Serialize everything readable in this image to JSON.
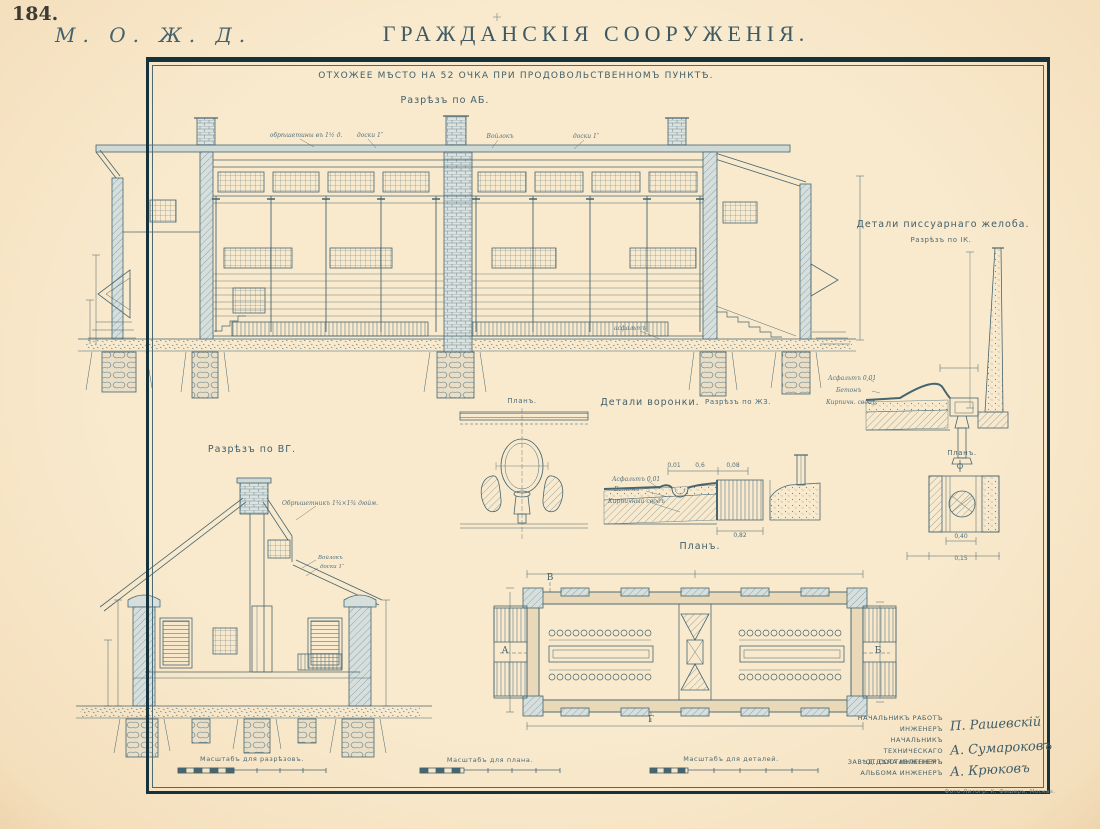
{
  "page": {
    "number": "184.",
    "railway": "М. О. Ж. Д.",
    "title": "ГРАЖДАНСКІЯ СООРУЖЕНІЯ.",
    "subtitle": "ОТХОЖЕЕ МѢСТО НА 52 ОЧКА ПРИ ПРОДОВОЛЬСТВЕННОМЪ ПУНКТѢ.",
    "imprint": "Фото-Литогр. К. Фишеръ, Москва."
  },
  "drawings": {
    "section_ab": {
      "label": "Разрѣзъ по АБ.",
      "roof_notes": [
        "обрѣшетины въ 1½ д.",
        "доски 1″",
        "Войлокъ",
        "доски 1″"
      ],
      "ground_note": "асфальтъ"
    },
    "section_vg": {
      "label": "Разрѣзъ по ВГ.",
      "roof_note": "Обрѣшетникъ 1¾×1¾ дюйм.",
      "layer_notes": [
        "Войлокъ",
        "доски 1″"
      ]
    },
    "plan": {
      "label": "Планъ.",
      "letters": [
        "В",
        "А",
        "Б",
        "Г"
      ],
      "seat_count": "52"
    },
    "funnel": {
      "title": "Детали воронки.",
      "plan_label": "Планъ.",
      "section_label": "Разрѣзъ по ЖЗ.",
      "materials": [
        "Асфальтъ 0,01",
        "Бетонъ",
        "Кирпичный сводъ"
      ],
      "dims": [
        "0,01",
        "0,6",
        "0,08",
        "0,82"
      ]
    },
    "urinal": {
      "title": "Детали писсуарнаго желоба.",
      "section_label": "Разрѣзъ по ІК.",
      "materials": [
        "Асфальтъ 0,01",
        "Бетонъ",
        "Кирпичн. сводъ"
      ]
    },
    "drain": {
      "plan_label": "Планъ.",
      "dims": [
        "0,40",
        "0,15"
      ]
    }
  },
  "scales": {
    "sections": "Масштабъ для разрѣзовъ.",
    "plan": "Масштабъ для плана.",
    "details": "Масштабъ для деталей."
  },
  "signatures": [
    {
      "role_line1": "НАЧАЛЬНИКЪ РАБОТЪ",
      "role_line2": "ИНЖЕНЕРЪ",
      "name": "П. Рашевскій"
    },
    {
      "role_line1": "НАЧАЛЬНИКЪ ТЕХНИЧЕСКАГО",
      "role_line2": "ОТДѢЛА ИНЖЕНЕРЪ",
      "name": "А. Сумароковъ"
    },
    {
      "role_line1": "ЗАВѢД. СОСТАВЛЕНІЕМЪ",
      "role_line2": "АЛЬБОМА ИНЖЕНЕРЪ",
      "name": "А. Крюковъ"
    }
  ],
  "colors": {
    "paper": "#f9eace",
    "ink": "#46656f",
    "frame": "#16333b"
  }
}
